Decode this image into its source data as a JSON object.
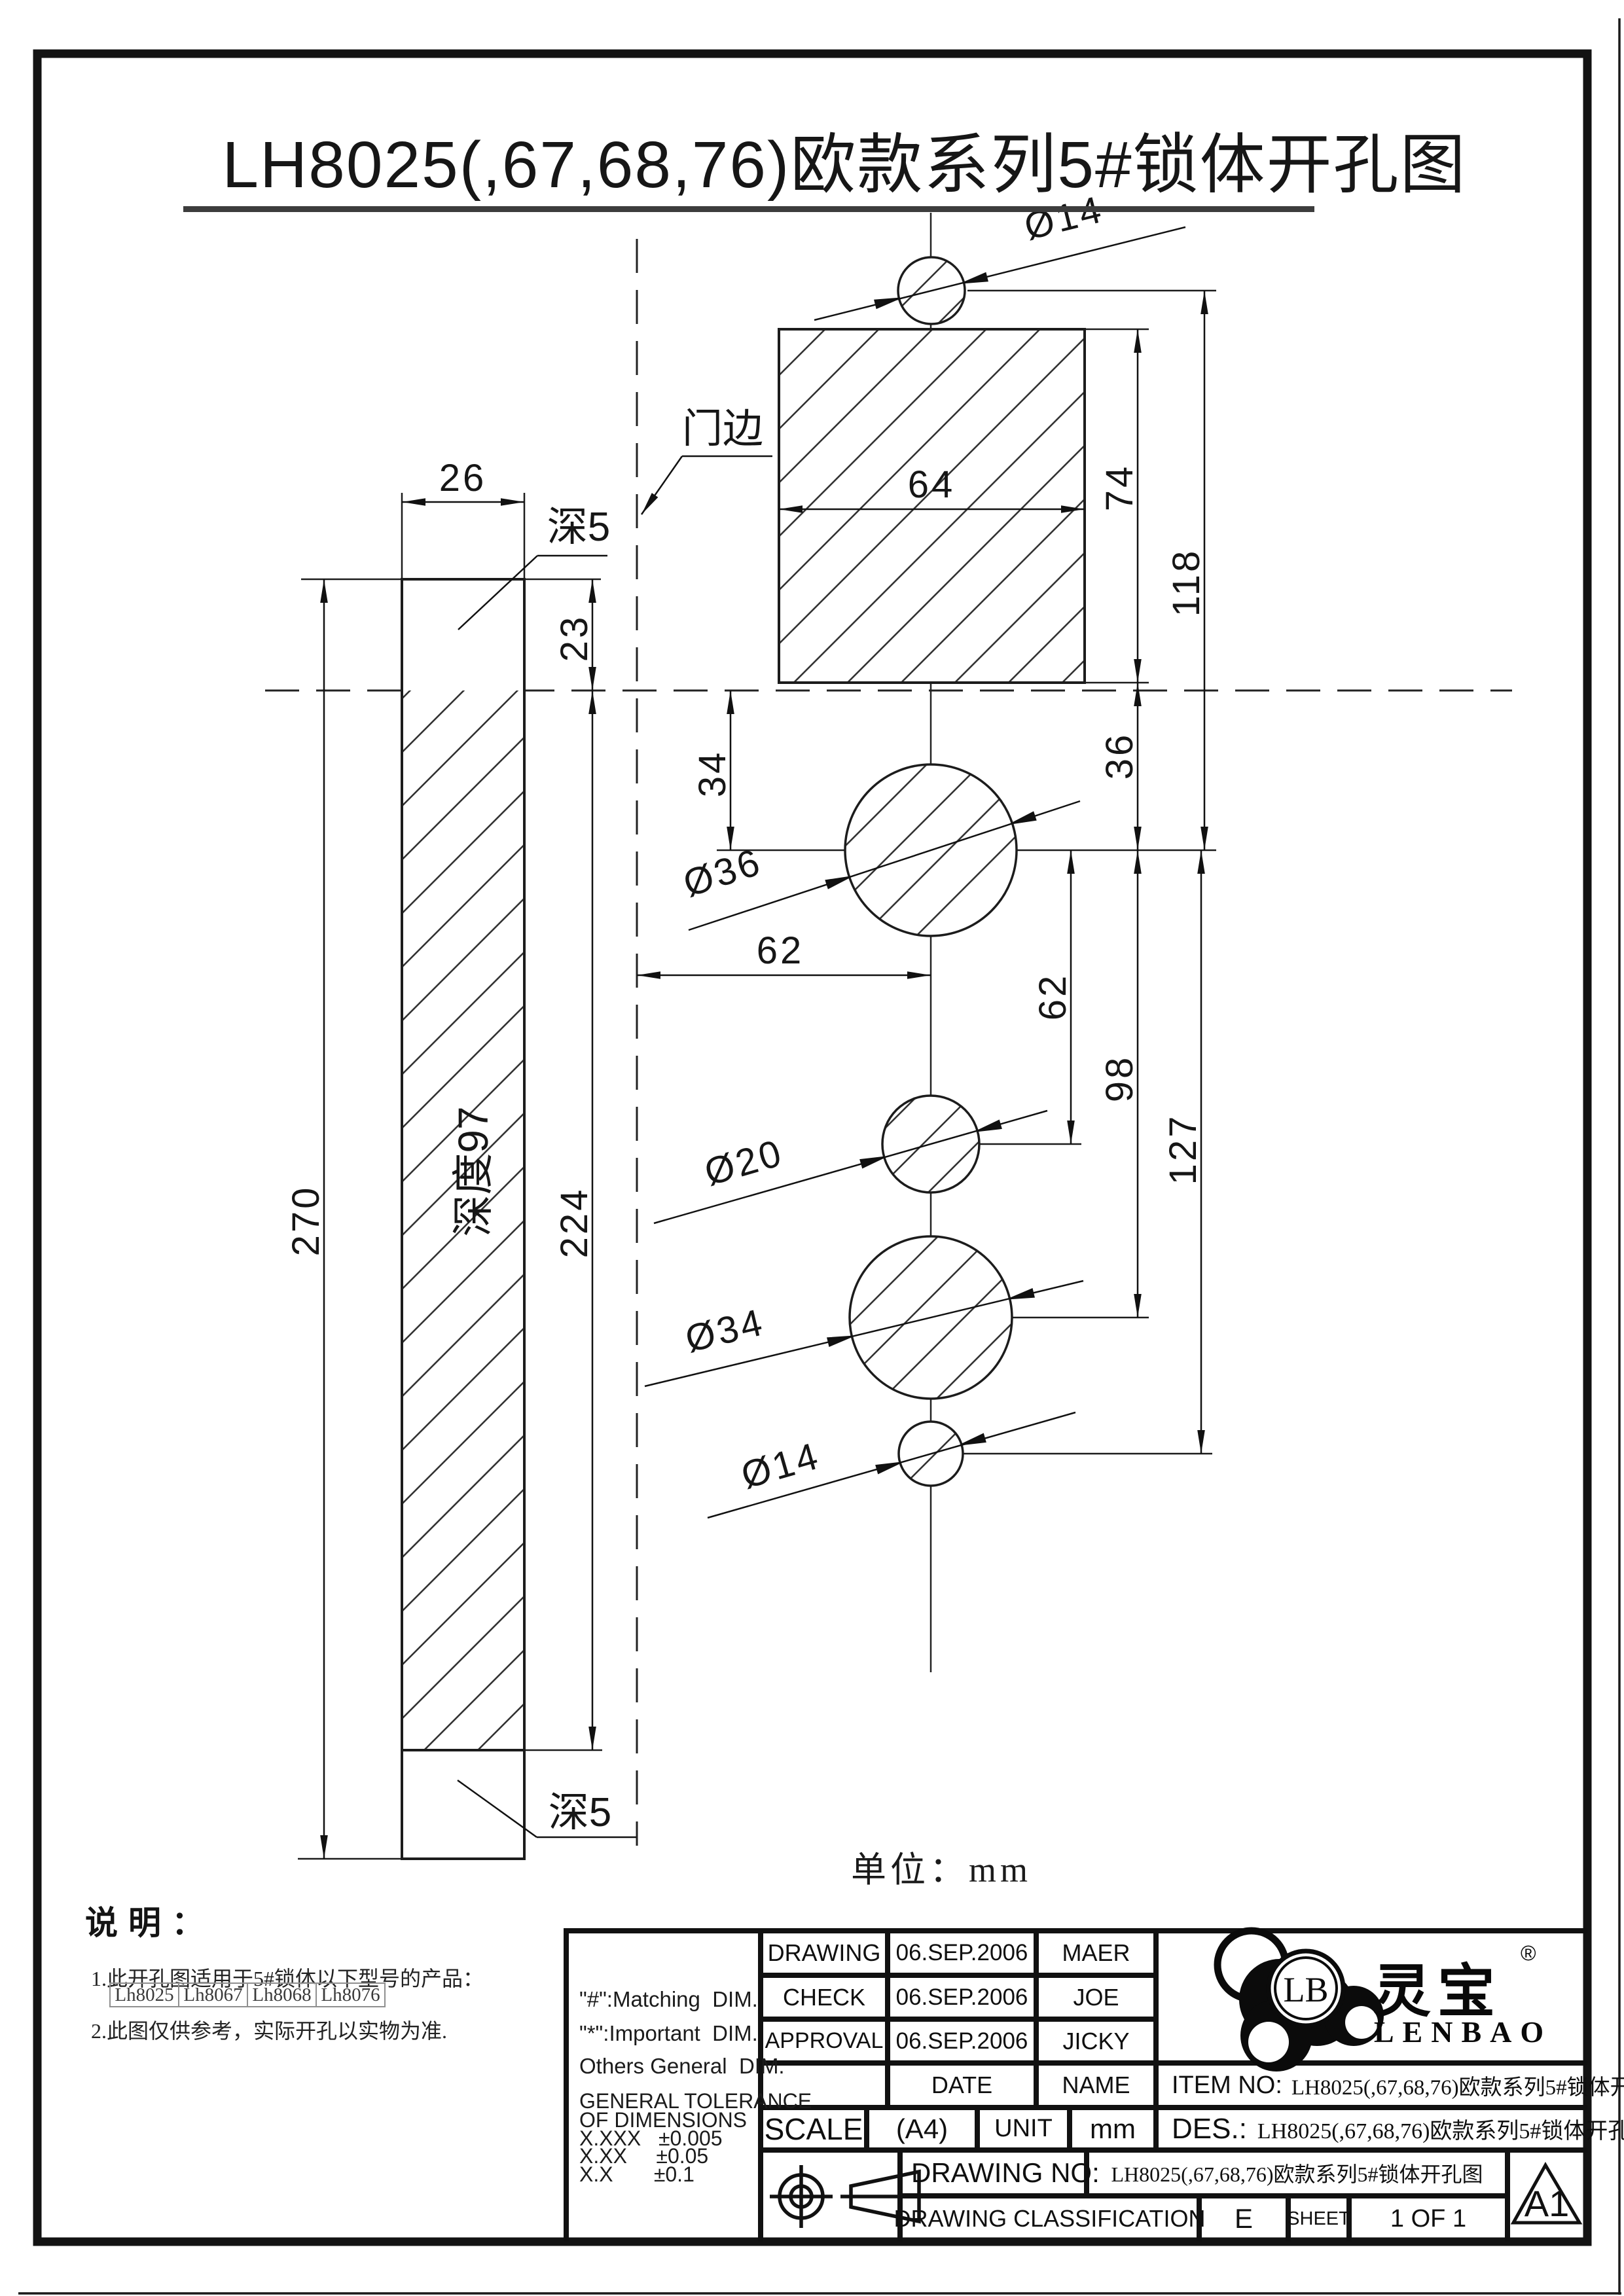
{
  "page": {
    "title": "LH8025(,67,68,76)欧款系列5#锁体开孔图",
    "unit_label": "单位：mm"
  },
  "drawing": {
    "labels": {
      "door_edge": "门边",
      "depth5_top": "深5",
      "depth5_bottom": "深5",
      "depth97": "深度97"
    },
    "dims": {
      "plate_width": "26",
      "plate_height": "270",
      "top_recess": "23",
      "hatch_height": "224",
      "case_width": "64",
      "case_height": "74",
      "d118": "118",
      "d34": "34",
      "d36": "36",
      "d62_vertical": "62",
      "d62_horizontal": "62",
      "d98": "98",
      "d127": "127",
      "dia14_top": "Ø14",
      "dia36": "Ø36",
      "dia20": "Ø20",
      "dia34": "Ø34",
      "dia14_bottom": "Ø14"
    }
  },
  "notes": {
    "heading": "说明：",
    "item1": "1.此开孔图适用于5#锁体以下型号的产品：",
    "models": [
      "Lh8025",
      "Lh8067",
      "Lh8068",
      "Lh8076"
    ],
    "item2": "2.此图仅供参考，实际开孔以实物为准."
  },
  "titleblock": {
    "rows": {
      "drawing": "DRAWING",
      "check": "CHECK",
      "approval": "APPROVAL",
      "date": "DATE",
      "name": "NAME"
    },
    "dates": {
      "drawing": "06.SEP.2006",
      "check": "06.SEP.2006",
      "approval": "06.SEP.2006"
    },
    "names": {
      "drawing": "MAER",
      "check": "JOE",
      "approval": "JICKY"
    },
    "scale_label": "SCALE",
    "paper": "(A4)",
    "unit_label": "UNIT",
    "unit_value": "mm",
    "item_label": "ITEM NO:",
    "item_value": "LH8025(,67,68,76)欧款系列5#锁体开孔图",
    "des_label": "DES.:",
    "des_value": "LH8025(,67,68,76)欧款系列5#锁体开孔图",
    "drawing_no_label": "DRAWING NO:",
    "drawing_no_value": "LH8025(,67,68,76)欧款系列5#锁体开孔图",
    "classification_label": "DRAWING CLASSIFICATION",
    "classification_value": "E",
    "sheet_label": "SHEET",
    "sheet_value": "1 OF 1",
    "format_code": "A1",
    "tolerance": [
      "\"#\":Matching  DIM.",
      "\"*\":Important  DIM.",
      "Others General  DIM.",
      "GENERAL TOLERANCE",
      "OF DIMENSIONS",
      "X.XXX   ±0.005",
      "X.XX     ±0.05",
      "X.X       ±0.1"
    ],
    "logo": {
      "lb": "LB",
      "cn": "灵宝",
      "reg": "®",
      "en": "LENBAO"
    }
  }
}
